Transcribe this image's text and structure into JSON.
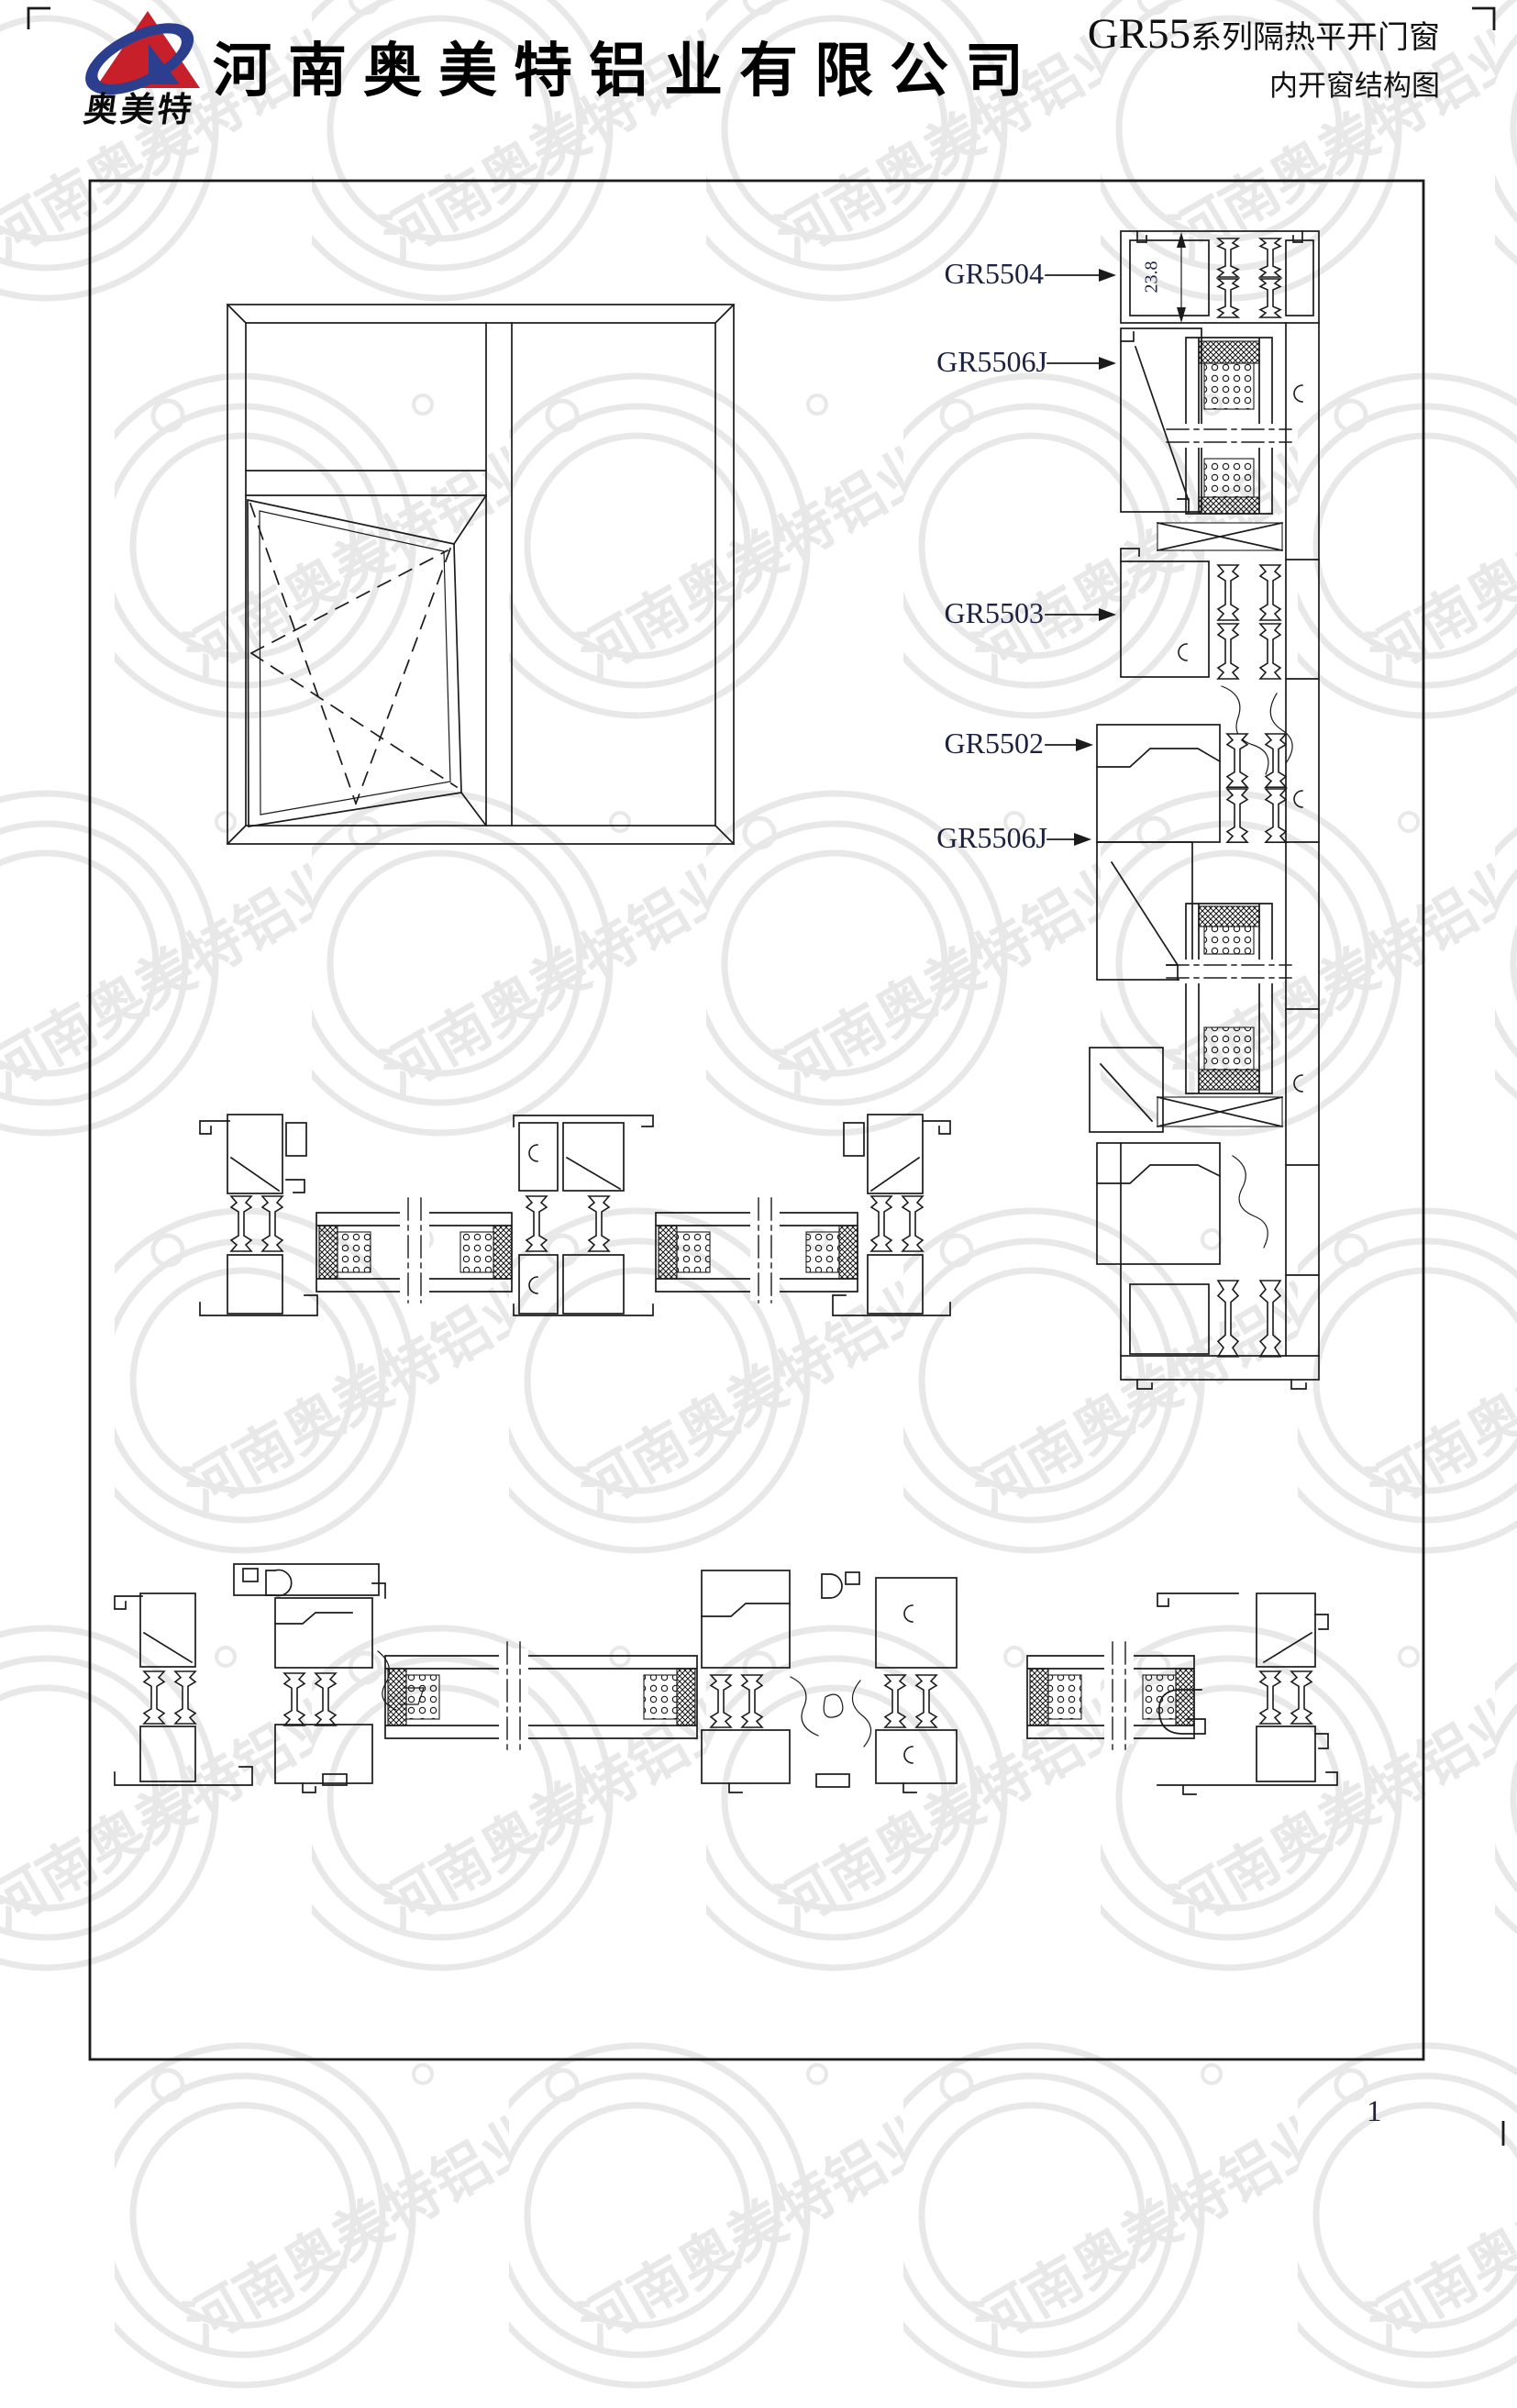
{
  "header": {
    "company_name": "河南奥美特铝业有限公司",
    "logo_text": "奥美特",
    "series_code": "GR55",
    "series_suffix": "系列隔热平开门窗",
    "drawing_title": "内开窗结构图"
  },
  "labels": {
    "parts": [
      "GR5504",
      "GR5506J",
      "GR5503",
      "GR5502",
      "GR5506J"
    ],
    "dimension": "23.8"
  },
  "watermark": {
    "text": "河南奥美特铝业"
  },
  "page": {
    "number": "1"
  },
  "colors": {
    "line": "#1b1b1b",
    "label_text": "#1c2240",
    "logo_red": "#c8202a",
    "logo_blue": "#2c3f8e",
    "watermark": "#e8e8e8"
  }
}
